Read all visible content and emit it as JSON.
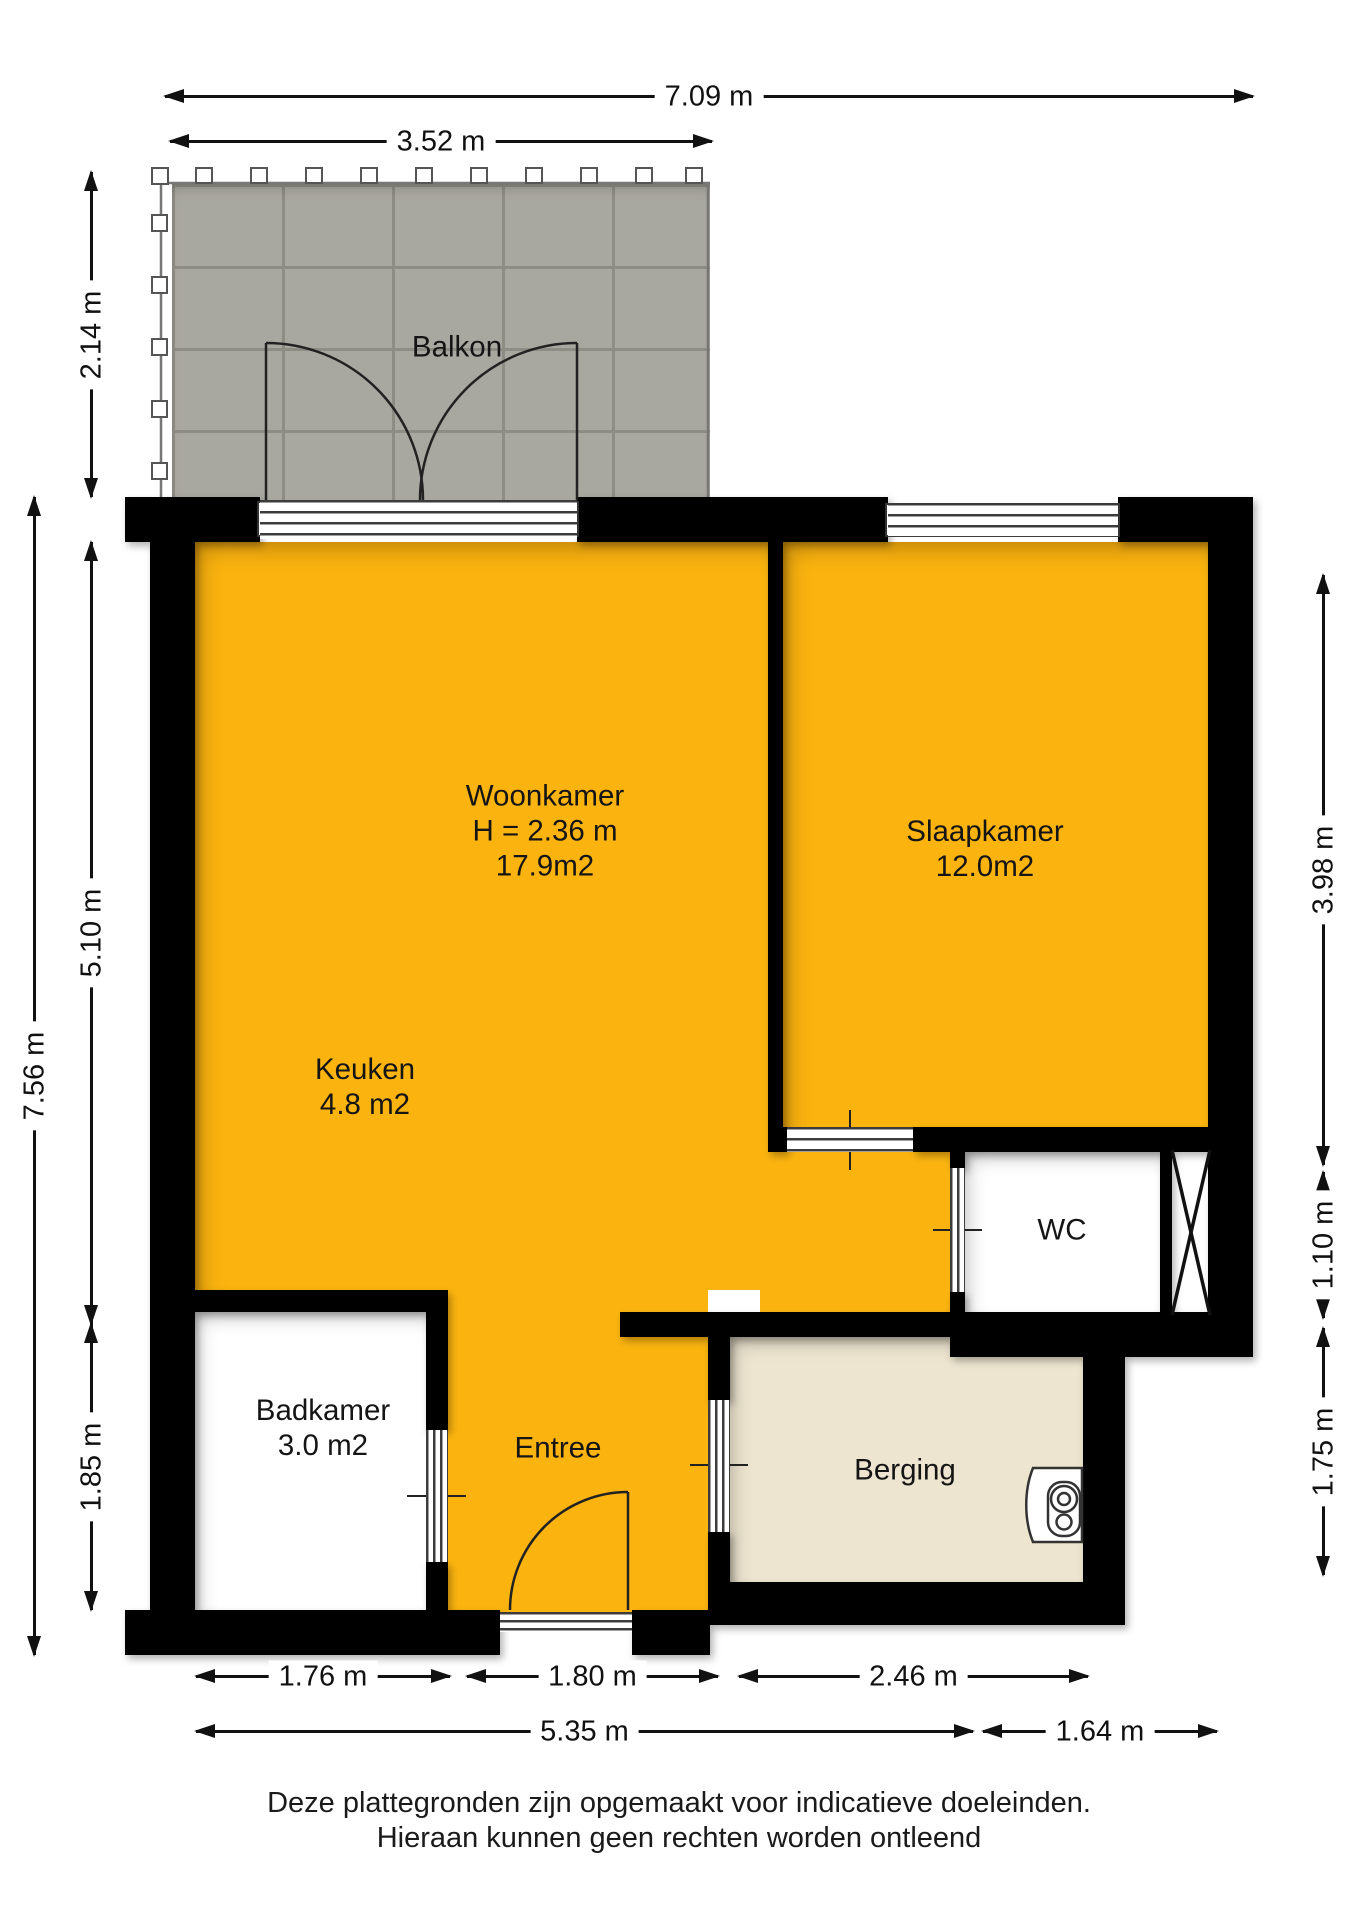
{
  "plan": {
    "rooms": {
      "balkon": {
        "label": "Balkon"
      },
      "woonkamer": {
        "label": "Woonkamer",
        "height_note": "H = 2.36 m",
        "area": "17.9m2"
      },
      "slaapkamer": {
        "label": "Slaapkamer",
        "area": "12.0m2"
      },
      "keuken": {
        "label": "Keuken",
        "area": "4.8 m2"
      },
      "wc": {
        "label": "WC"
      },
      "badkamer": {
        "label": "Badkamer",
        "area": "3.0 m2"
      },
      "entree": {
        "label": "Entree"
      },
      "berging": {
        "label": "Berging"
      }
    },
    "dimensions": {
      "top_total": "7.09 m",
      "top_balcony": "3.52 m",
      "left_total": "7.56 m",
      "left_balcony": "2.14 m",
      "left_livingroom": "5.10 m",
      "left_bathroom": "1.85 m",
      "right_bedroom": "3.98 m",
      "right_wc": "1.10 m",
      "right_storage": "1.75 m",
      "bottom_bathroom": "1.76 m",
      "bottom_entry": "1.80 m",
      "bottom_storage": "2.46 m",
      "bottom_left_total": "5.35 m",
      "bottom_right_total": "1.64 m"
    },
    "disclaimer": {
      "line1": "Deze plattegronden zijn opgemaakt voor indicatieve doeleinden.",
      "line2": "Hieraan kunnen geen rechten worden ontleend"
    },
    "colors": {
      "room_fill": "#FBB40F",
      "storage_fill": "#EDE5CF",
      "wall": "#000000",
      "balcony_tile": "#A9A8A0"
    }
  }
}
